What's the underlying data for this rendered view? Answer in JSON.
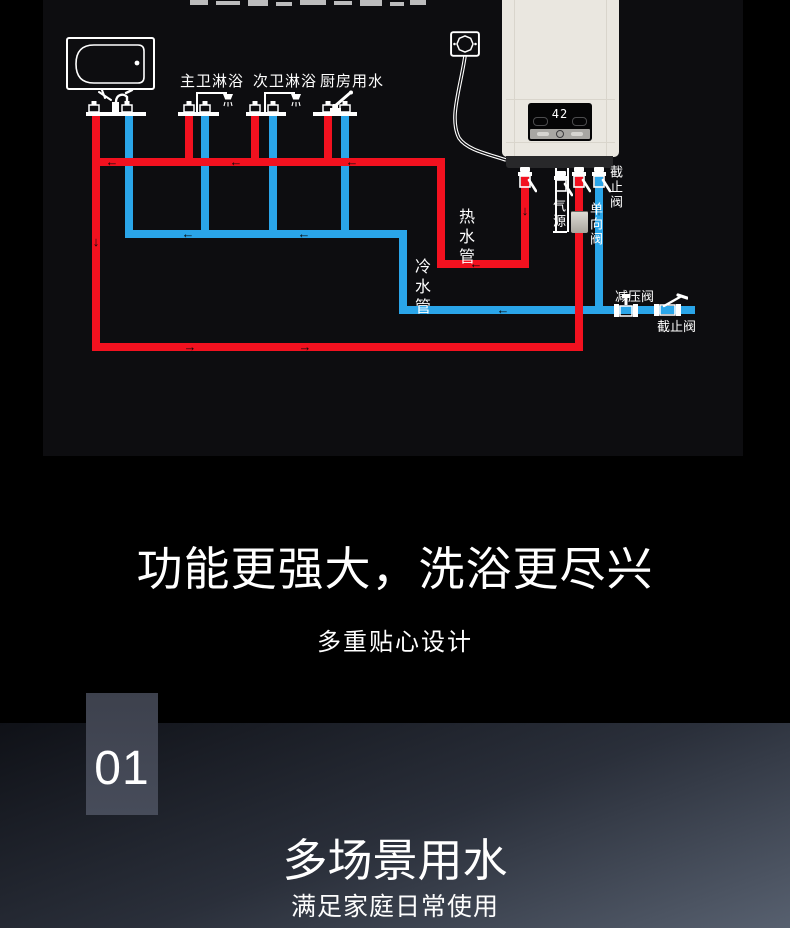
{
  "diagram": {
    "fixture_labels": [
      "主卫淋浴",
      "次卫淋浴",
      "厨房用水"
    ],
    "pipe_labels": {
      "hot": "热水管",
      "cold": "冷水管",
      "gas": "气源",
      "check_valve": "单向阀",
      "stop_valve_heater": "截止阀",
      "pressure_reducing_valve": "减压阀",
      "stop_valve_inlet": "截止阀"
    },
    "heater": {
      "temperature": "42"
    },
    "flow_icons": {
      "left": "←",
      "right": "→",
      "up": "↑",
      "down": "↓"
    },
    "colors": {
      "hot_pipe": "#f2111f",
      "cold_pipe": "#2aa5e9",
      "heater_body": "#eae7e0",
      "panel_bg": "#0d0d10"
    }
  },
  "feature_section": {
    "title": "功能更强大，洗浴更尽兴",
    "subtitle": "多重贴心设计"
  },
  "scene_section": {
    "number": "01",
    "title": "多场景用水",
    "subtitle": "满足家庭日常使用"
  }
}
